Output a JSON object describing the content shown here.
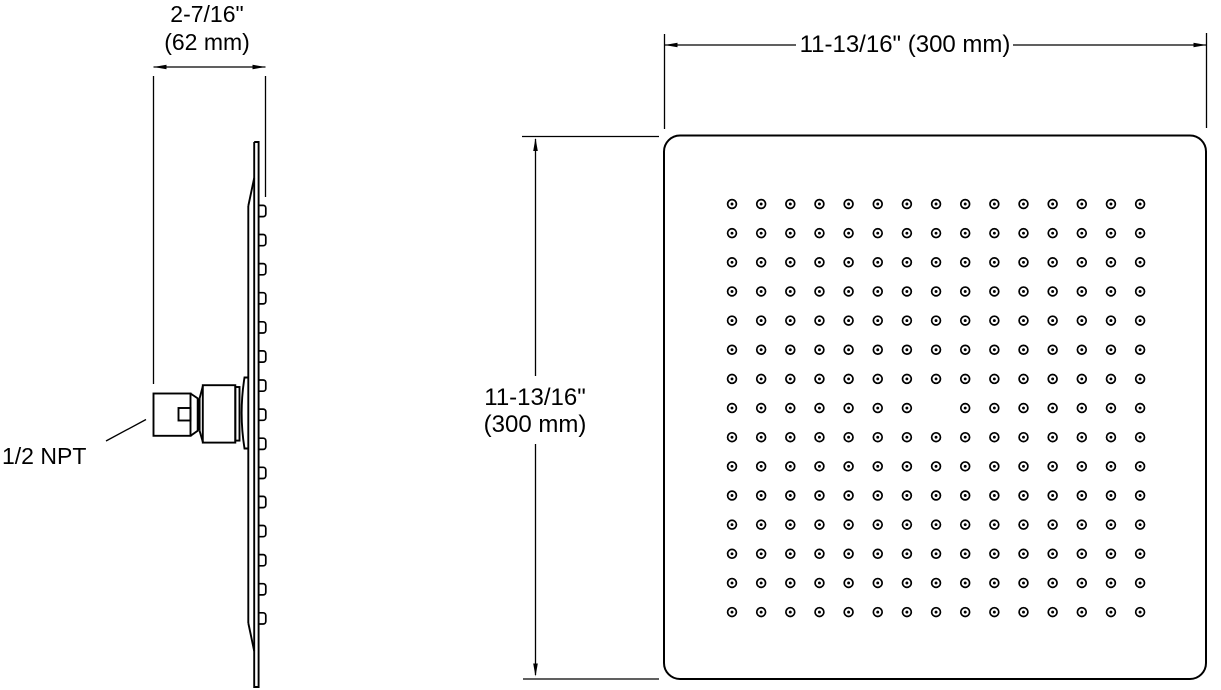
{
  "drawing": {
    "subject": "square-rainhead-two-view-dimension-drawing",
    "colors": {
      "background": "#ffffff",
      "line": "#000000"
    }
  },
  "side_view": {
    "npt_label": "1/2 NPT",
    "width_dim": {
      "line1": "2-7/16\"",
      "line2": "(62 mm)"
    },
    "nozzle_count": 15
  },
  "front_view": {
    "width_dim": "11-13/16\" (300 mm)",
    "height_dim": {
      "line1": "11-13/16\"",
      "line2": "(300 mm)"
    },
    "nozzle_grid": {
      "rows": 15,
      "cols": 15,
      "center_missing": true
    }
  }
}
